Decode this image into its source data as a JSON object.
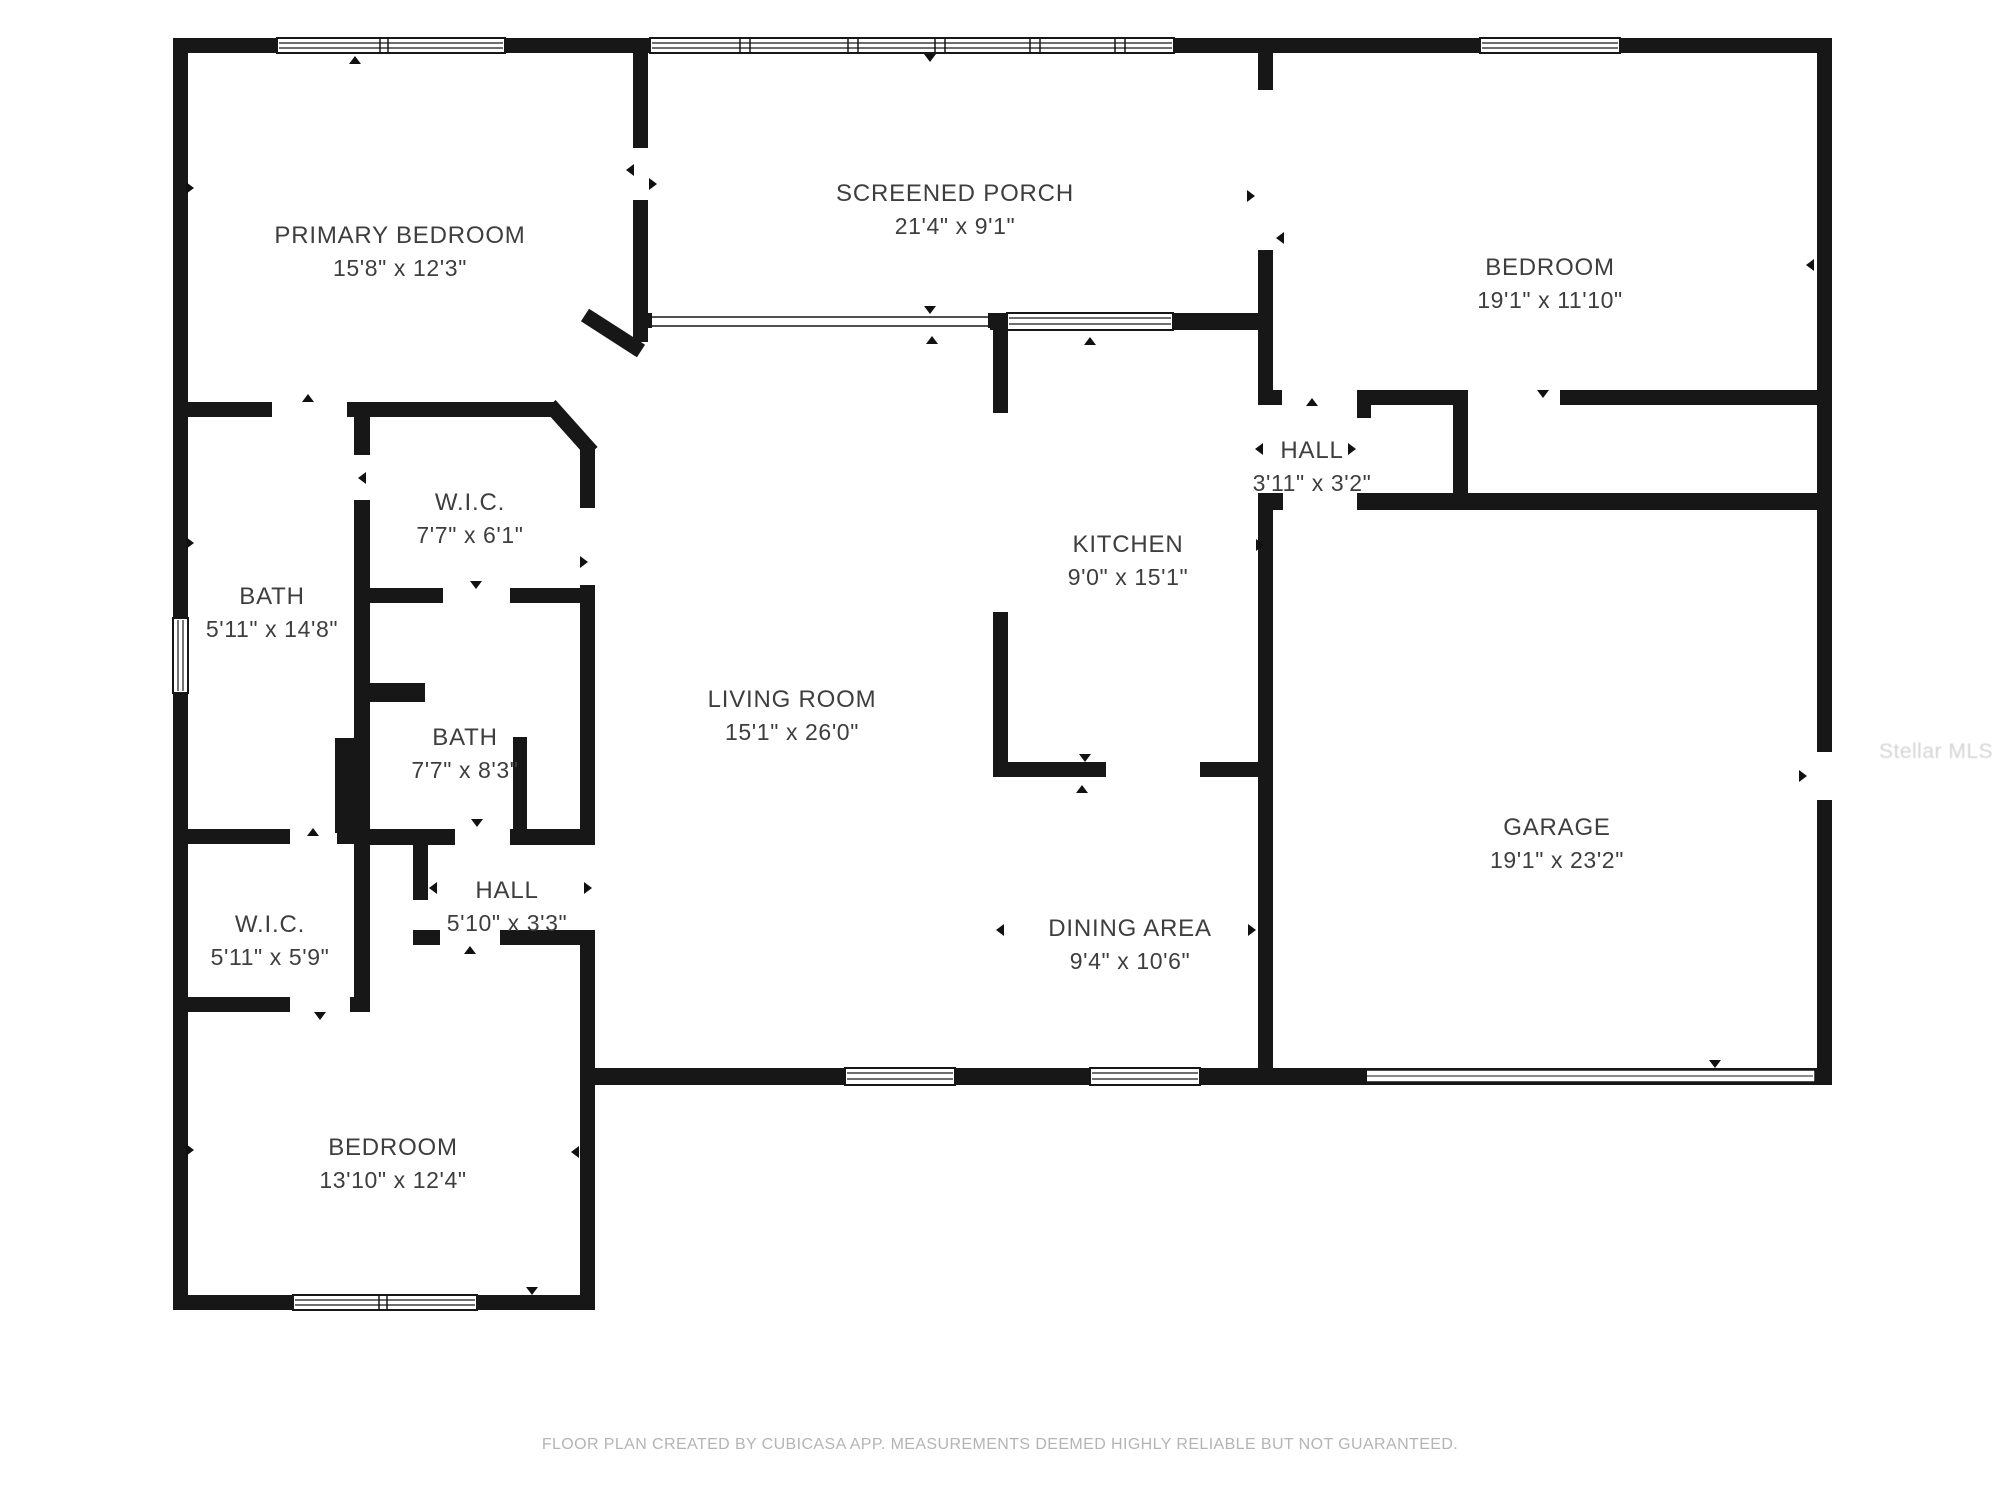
{
  "plan": {
    "rooms": [
      {
        "id": "primary-bedroom",
        "name": "PRIMARY BEDROOM",
        "dims": "15'8\" x 12'3\""
      },
      {
        "id": "screened-porch",
        "name": "SCREENED PORCH",
        "dims": "21'4\" x 9'1\""
      },
      {
        "id": "bedroom-top-right",
        "name": "BEDROOM",
        "dims": "19'1\" x 11'10\""
      },
      {
        "id": "wic-primary",
        "name": "W.I.C.",
        "dims": "7'7\" x 6'1\""
      },
      {
        "id": "bath-primary",
        "name": "BATH",
        "dims": "5'11\" x 14'8\""
      },
      {
        "id": "bath-hall",
        "name": "BATH",
        "dims": "7'7\" x 8'3\""
      },
      {
        "id": "hall-left",
        "name": "HALL",
        "dims": "5'10\" x 3'3\""
      },
      {
        "id": "wic-second",
        "name": "W.I.C.",
        "dims": "5'11\" x 5'9\""
      },
      {
        "id": "bedroom-bottom-left",
        "name": "BEDROOM",
        "dims": "13'10\" x 12'4\""
      },
      {
        "id": "living-room",
        "name": "LIVING ROOM",
        "dims": "15'1\" x 26'0\""
      },
      {
        "id": "kitchen",
        "name": "KITCHEN",
        "dims": "9'0\" x 15'1\""
      },
      {
        "id": "dining-area",
        "name": "DINING AREA",
        "dims": "9'4\" x 10'6\""
      },
      {
        "id": "hall-right",
        "name": "HALL",
        "dims": "3'11\" x 3'2\""
      },
      {
        "id": "garage",
        "name": "GARAGE",
        "dims": "19'1\" x 23'2\""
      }
    ],
    "footer": "FLOOR PLAN CREATED BY CUBICASA APP. MEASUREMENTS DEEMED HIGHLY RELIABLE BUT NOT GUARANTEED.",
    "watermark": "Stellar MLS",
    "colors": {
      "wall": "#171717",
      "label": "#3e3e3e",
      "footer": "#b4b4b4",
      "watermark": "#d4d4d4",
      "background": "#ffffff"
    }
  }
}
